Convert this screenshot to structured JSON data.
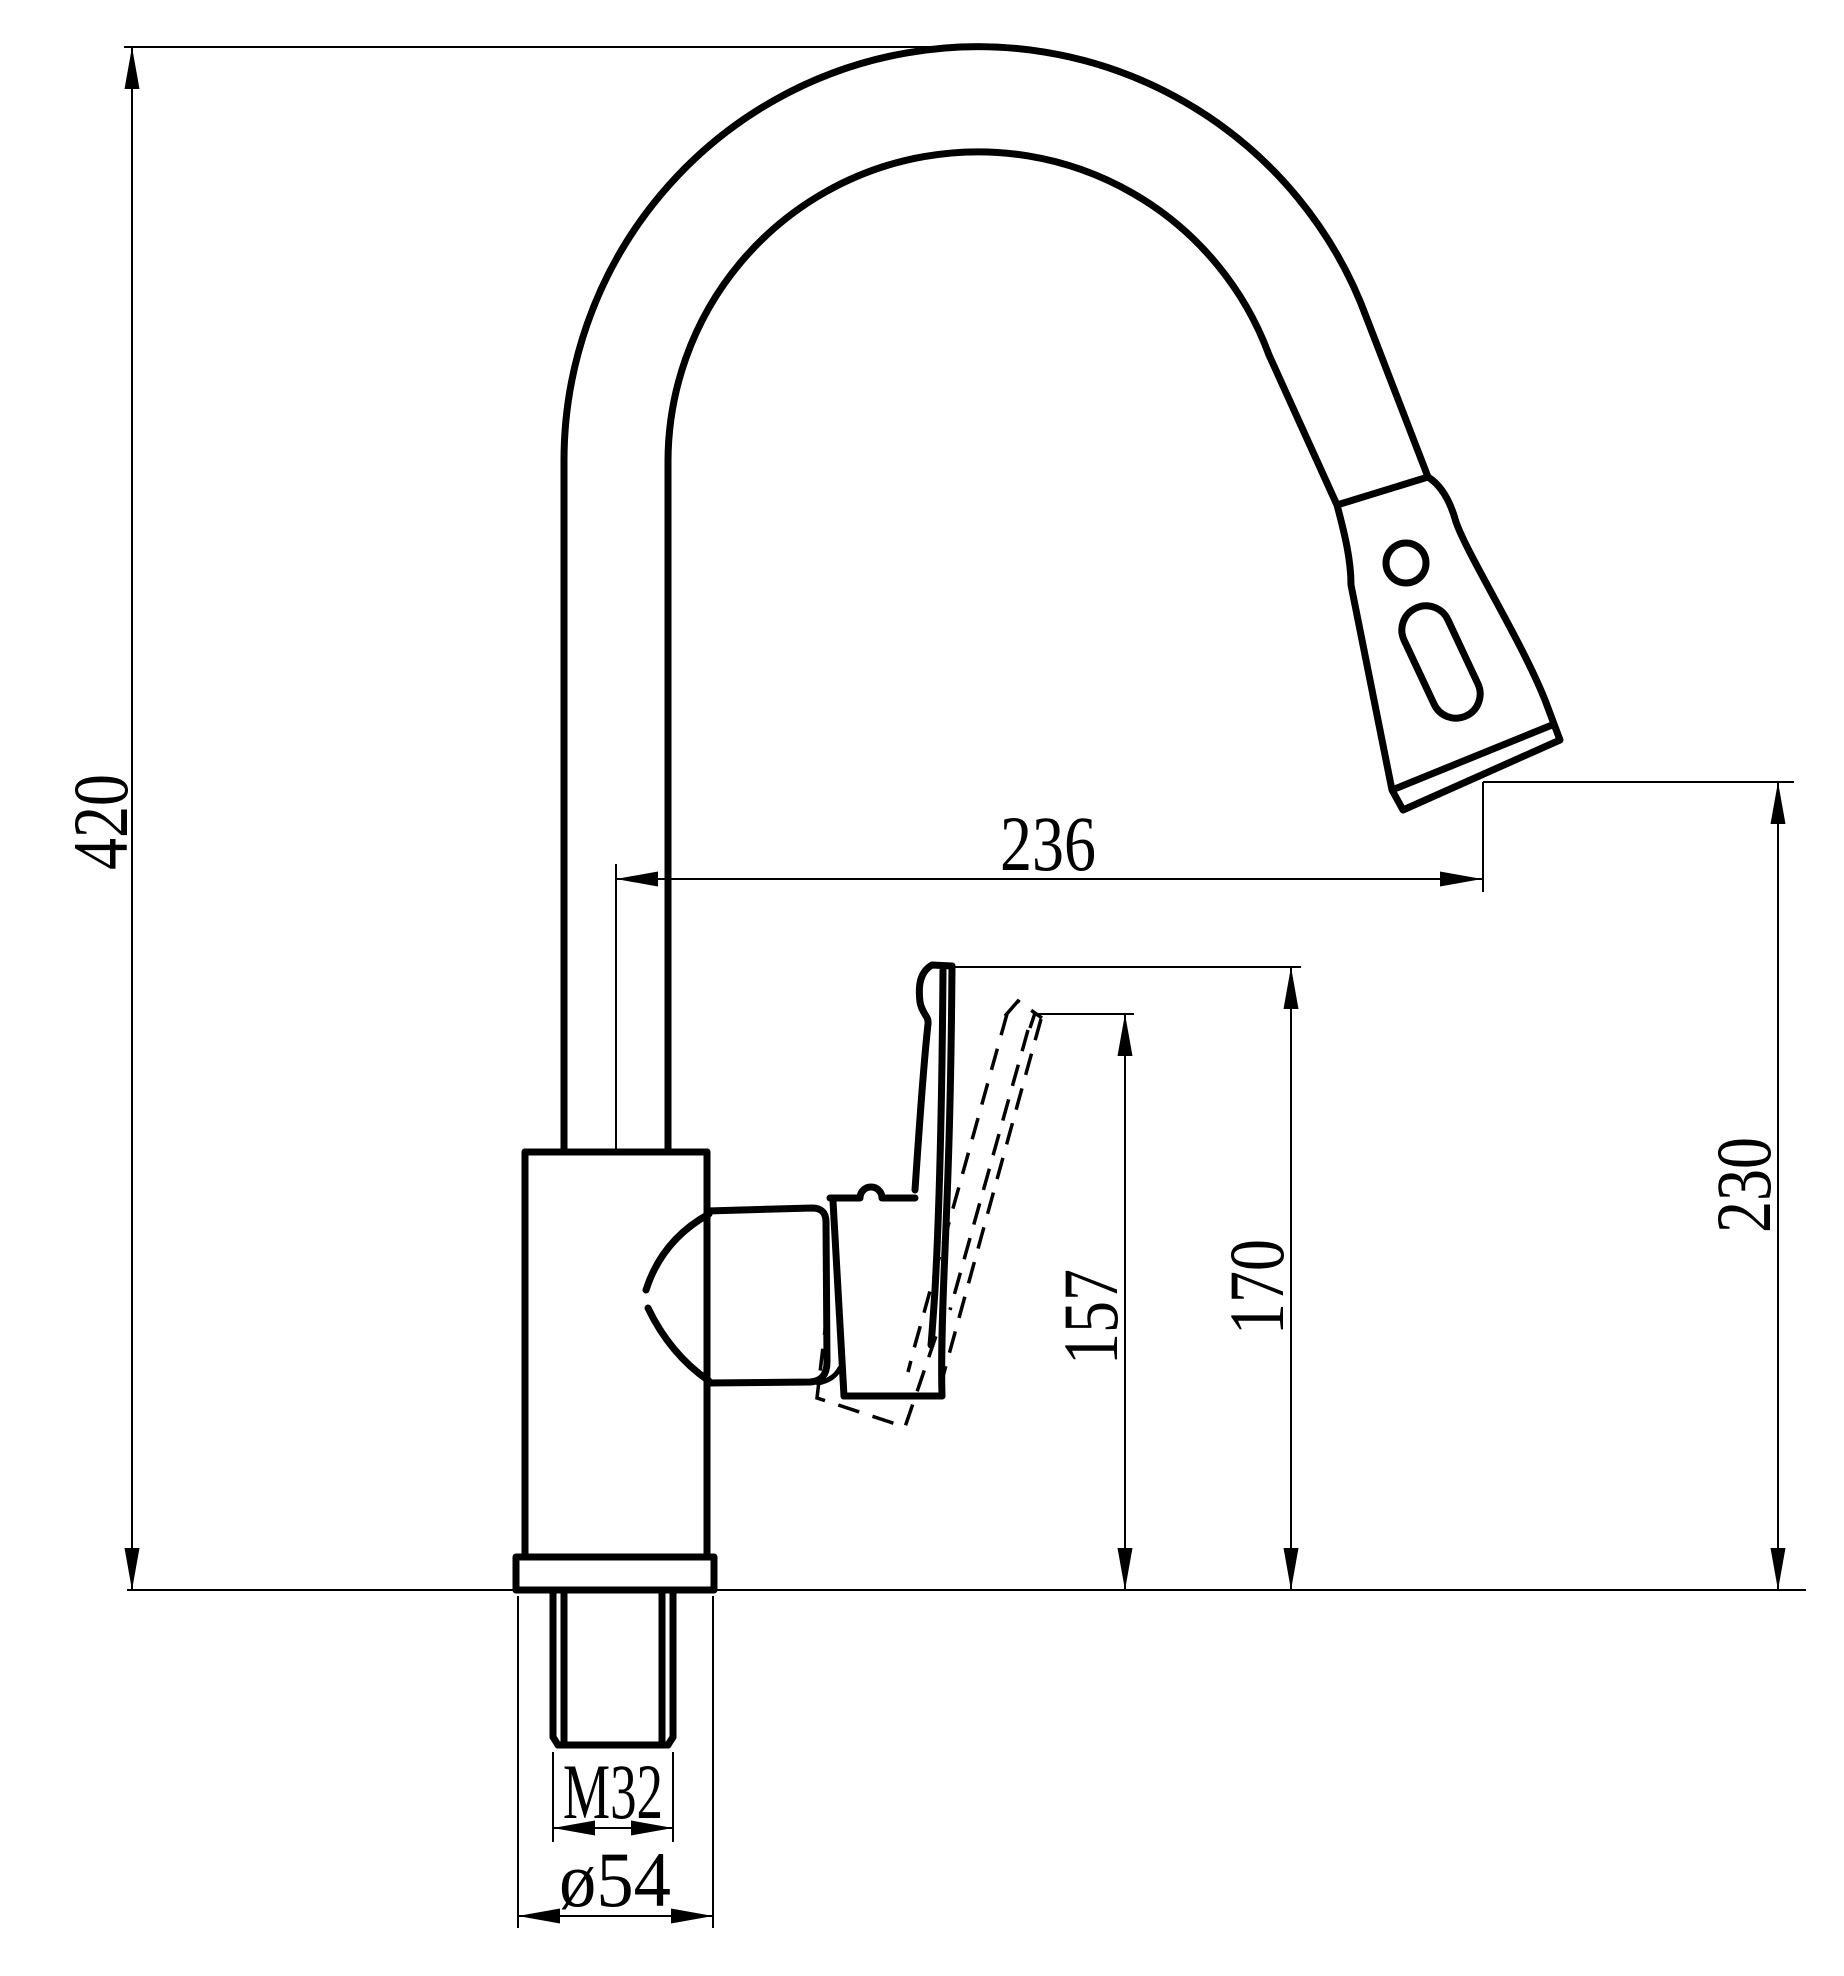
{
  "drawing": {
    "type": "technical-drawing",
    "subject": "pull-down kitchen faucet, side elevation with dimensions",
    "units": "mm",
    "colors": {
      "line": "#000000",
      "background": "#ffffff"
    },
    "dimensions": {
      "total_height": {
        "label": "420",
        "meaning": "overall height from mounting surface to top of spout arc"
      },
      "spout_reach": {
        "label": "236",
        "meaning": "horizontal reach from riser axis to outlet"
      },
      "outlet_height": {
        "label": "230",
        "meaning": "height from mounting surface to spray outlet"
      },
      "handle_height": {
        "label": "170",
        "meaning": "height to top of handle (upright position)"
      },
      "handle_tilted_height": {
        "label": "157",
        "meaning": "height to top of handle (tilted position)"
      },
      "thread_size": {
        "label": "M32",
        "meaning": "mounting shank thread"
      },
      "base_diameter": {
        "label": "ø54",
        "meaning": "base flange diameter"
      }
    }
  }
}
